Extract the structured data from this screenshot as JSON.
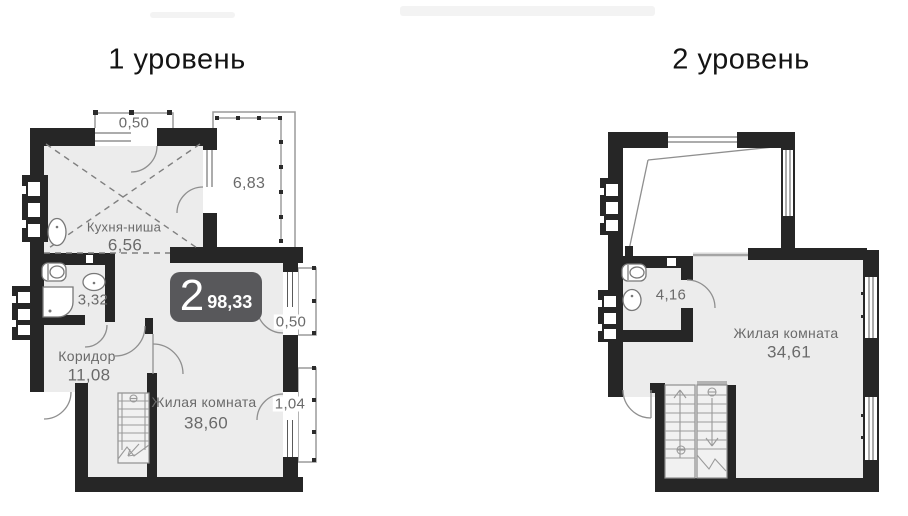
{
  "level1": {
    "title": "1 уровень",
    "badge": {
      "rooms": "2",
      "total_area": "98,33"
    },
    "kitchen": {
      "name": "Кухня-ниша",
      "area": "6,56"
    },
    "bathroom": {
      "area": "3,32"
    },
    "corridor": {
      "name": "Коридор",
      "area": "11,08"
    },
    "living": {
      "name": "Жилая комната",
      "area": "38,60"
    },
    "balcony_top": {
      "area": "0,50"
    },
    "balcony_big": {
      "area": "6,83"
    },
    "balcony_mid": {
      "area": "0,50"
    },
    "balcony_low": {
      "area": "1,04"
    }
  },
  "level2": {
    "title": "2 уровень",
    "bathroom": {
      "area": "4,16"
    },
    "living": {
      "name": "Жилая комната",
      "area": "34,61"
    }
  },
  "colors": {
    "wall": "#262626",
    "floor": "#ececec",
    "badge": "#58585b",
    "line": "#8f8f8f"
  }
}
